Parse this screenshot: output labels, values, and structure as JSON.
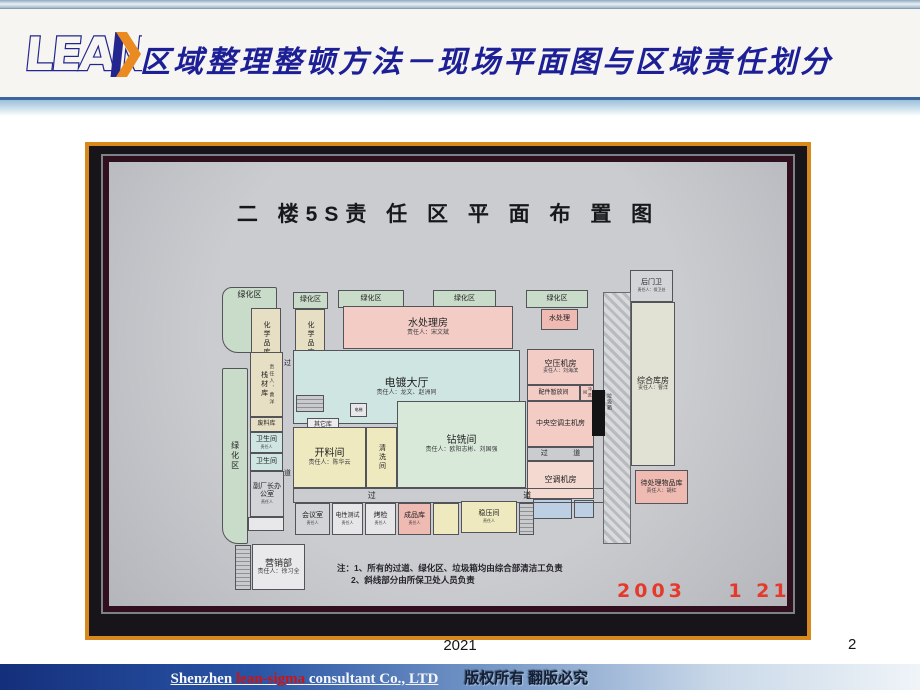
{
  "header": {
    "logo_text": "LEAN",
    "title": "区域整理整顿方法－现场平面图与区域责任划分"
  },
  "photo": {
    "board_title": "二 楼5S责 任 区 平 面 布 置 图",
    "date": "2003    1 21",
    "notes_line1": "注：1、所有的过道、绿化区、垃圾箱均由综合部清洁工负责",
    "notes_line2": "2、斜线部分由所保卫处人员负责",
    "trash_label": "垃圾箱",
    "rooms": [
      {
        "name": "green-area-1",
        "label": "绿化区",
        "x": 133,
        "y": 141,
        "w": 55,
        "h": 66,
        "bg": "#c9dbc9",
        "round": "10px 2px 2px 16px",
        "top": 1,
        "fs": 8
      },
      {
        "name": "green-area-2",
        "label": "绿化区",
        "x": 204,
        "y": 146,
        "w": 35,
        "h": 17,
        "bg": "#c9dbc9",
        "fs": 7
      },
      {
        "name": "green-area-3",
        "label": "绿化区",
        "x": 249,
        "y": 144,
        "w": 66,
        "h": 18,
        "bg": "#c9dbc9",
        "fs": 7
      },
      {
        "name": "green-area-4",
        "label": "绿化区",
        "x": 344,
        "y": 144,
        "w": 63,
        "h": 18,
        "bg": "#c9dbc9",
        "fs": 7
      },
      {
        "name": "green-area-5",
        "label": "绿化区",
        "x": 437,
        "y": 144,
        "w": 62,
        "h": 18,
        "bg": "#c9dbc9",
        "fs": 7
      },
      {
        "name": "chemical-store-1",
        "label": "化学品库",
        "x": 162,
        "y": 162,
        "w": 30,
        "h": 62,
        "bg": "#e7dfc3",
        "vert": 1,
        "fs": 7
      },
      {
        "name": "chemical-store-2",
        "label": "化学品库",
        "x": 206,
        "y": 163,
        "w": 30,
        "h": 60,
        "bg": "#e7dfc3",
        "vert": 1,
        "fs": 7
      },
      {
        "name": "water-treatment-room",
        "label": "水处理房",
        "sub": "责任人：宋文斌",
        "x": 254,
        "y": 160,
        "w": 170,
        "h": 43,
        "bg": "#f2ccc5",
        "fs": 10,
        "sfs": 6
      },
      {
        "name": "water-treatment-small",
        "label": "水处理",
        "x": 452,
        "y": 163,
        "w": 37,
        "h": 21,
        "bg": "#eebab2",
        "fs": 7
      },
      {
        "name": "plating-hall",
        "label": "电镀大厅",
        "sub": "责任人：龙文、赵洲同",
        "x": 204,
        "y": 204,
        "w": 227,
        "h": 74,
        "bg": "#cfe5e1",
        "fs": 11,
        "sfs": 6
      },
      {
        "name": "air-compressor-room",
        "label": "空压机房",
        "sub": "责任人：刘海滨",
        "x": 438,
        "y": 203,
        "w": 67,
        "h": 36,
        "bg": "#f2ccc5",
        "fs": 8,
        "sfs": 5
      },
      {
        "name": "parts-staging-room",
        "label": "配件暂放间",
        "x": 438,
        "y": 239,
        "w": 53,
        "h": 16,
        "bg": "#f2ccc5",
        "fs": 6
      },
      {
        "name": "rinse-room",
        "label": "冲洗间",
        "x": 491,
        "y": 239,
        "w": 14,
        "h": 16,
        "bg": "#f2ccc5",
        "fs": 4,
        "vert": 1
      },
      {
        "name": "central-ac-room",
        "label": "中央空调主机房",
        "x": 438,
        "y": 255,
        "w": 67,
        "h": 46,
        "bg": "#f2ccc5",
        "fs": 7
      },
      {
        "name": "corridor-right",
        "label": "过",
        "label2": "道",
        "x": 438,
        "y": 301,
        "w": 67,
        "h": 14,
        "fs": 7
      },
      {
        "name": "ac-room",
        "label": "空调机房",
        "x": 438,
        "y": 315,
        "w": 67,
        "h": 38,
        "bg": "#f3d9d0",
        "fs": 8
      },
      {
        "name": "small-room-blue-1",
        "label": "",
        "x": 444,
        "y": 353,
        "w": 39,
        "h": 20,
        "bg": "#bdd0e3"
      },
      {
        "name": "small-room-blue-2",
        "label": "",
        "x": 485,
        "y": 354,
        "w": 20,
        "h": 18,
        "bg": "#bdd0e3"
      },
      {
        "name": "back-gate-guard",
        "label": "后门卫",
        "sub": "责任人：保卫处",
        "x": 541,
        "y": 124,
        "w": 43,
        "h": 32,
        "bg": "#d3d4d7",
        "fs": 7,
        "sfs": 4
      },
      {
        "name": "general-warehouse",
        "label": "综合库房",
        "sub": "责任人：曹洋",
        "x": 542,
        "y": 156,
        "w": 44,
        "h": 164,
        "bg": "#e2e2d4",
        "fs": 8,
        "sfs": 5
      },
      {
        "name": "pending-items-store",
        "label": "待处理物品库",
        "sub": "责任人：胡红",
        "x": 546,
        "y": 324,
        "w": 53,
        "h": 34,
        "bg": "#eebab2",
        "fs": 7,
        "sfs": 5
      },
      {
        "name": "green-area-left",
        "label": "绿化区",
        "x": 133,
        "y": 222,
        "w": 26,
        "h": 176,
        "bg": "#c9dbc9",
        "vert": 1,
        "round": "2px 2px 2px 16px",
        "fs": 8
      },
      {
        "name": "rack-material-store",
        "label": "栈材库",
        "sub": "责任人、曹洋",
        "x": 161,
        "y": 206,
        "w": 33,
        "h": 65,
        "bg": "#e7dfc3",
        "fs": 7,
        "sfs": 5,
        "vert": 1
      },
      {
        "name": "waste-store",
        "label": "废料库",
        "x": 161,
        "y": 271,
        "w": 33,
        "h": 15,
        "bg": "#e7dfc3",
        "fs": 6
      },
      {
        "name": "restroom-1",
        "label": "卫生间",
        "sub": "责任人",
        "x": 161,
        "y": 286,
        "w": 33,
        "h": 21,
        "bg": "#cfe5e1",
        "fs": 7,
        "sfs": 4
      },
      {
        "name": "restroom-2",
        "label": "卫生间",
        "x": 161,
        "y": 307,
        "w": 33,
        "h": 18,
        "bg": "#cfe5e1",
        "fs": 7
      },
      {
        "name": "deputy-director-office",
        "label": "副厂长办公室",
        "sub": "责任人",
        "x": 161,
        "y": 325,
        "w": 34,
        "h": 46,
        "bg": "#d3d4d7",
        "fs": 7,
        "sfs": 4
      },
      {
        "name": "small-room-1",
        "label": "",
        "x": 159,
        "y": 371,
        "w": 36,
        "h": 14,
        "bg": "#e8e8ea"
      },
      {
        "name": "corridor-char-top",
        "label": "过",
        "x": 193,
        "y": 212,
        "w": 11,
        "h": 13,
        "fs": 7,
        "noborder": 1
      },
      {
        "name": "corridor-char-bottom",
        "label": "道",
        "x": 193,
        "y": 322,
        "w": 11,
        "h": 13,
        "fs": 7,
        "noborder": 1
      },
      {
        "name": "stairs-mid",
        "label": "",
        "x": 207,
        "y": 249,
        "w": 28,
        "h": 17,
        "stairs": 1
      },
      {
        "name": "elevator",
        "label": "电梯",
        "x": 261,
        "y": 257,
        "w": 17,
        "h": 14,
        "bg": "#e8e8ea",
        "fs": 4
      },
      {
        "name": "other-store",
        "label": "其它库",
        "x": 218,
        "y": 272,
        "w": 32,
        "h": 14,
        "bg": "#ececee",
        "fs": 6
      },
      {
        "name": "cutting-room",
        "label": "开料间",
        "sub": "责任人：陈华云",
        "x": 204,
        "y": 281,
        "w": 73,
        "h": 61,
        "bg": "#efe9c0",
        "fs": 10,
        "sfs": 6
      },
      {
        "name": "cleaning-room",
        "label": "清洗间",
        "x": 277,
        "y": 281,
        "w": 31,
        "h": 61,
        "bg": "#efe9c0",
        "fs": 7,
        "vert": 1
      },
      {
        "name": "drilling-milling-room",
        "label": "钻铣间",
        "sub": "责任人：欧阳志彬、刘国强",
        "x": 308,
        "y": 255,
        "w": 129,
        "h": 87,
        "bg": "#d8e9da",
        "fs": 10,
        "sfs": 6
      },
      {
        "name": "corridor-main",
        "label": "过",
        "label2": "道",
        "x": 204,
        "y": 342,
        "w": 313,
        "h": 15,
        "fs": 8
      },
      {
        "name": "meeting-room",
        "label": "会议室",
        "sub": "责任人",
        "x": 206,
        "y": 357,
        "w": 35,
        "h": 32,
        "bg": "#d3d4d7",
        "fs": 7,
        "sfs": 4
      },
      {
        "name": "electrical-test-room",
        "label": "电性测试",
        "sub": "责任人",
        "x": 243,
        "y": 357,
        "w": 31,
        "h": 32,
        "bg": "#e6e6e8",
        "fs": 6,
        "sfs": 4
      },
      {
        "name": "bake-inspection-room",
        "label": "烤检",
        "sub": "责任人",
        "x": 276,
        "y": 357,
        "w": 31,
        "h": 32,
        "bg": "#e6e6e8",
        "fs": 7,
        "sfs": 4
      },
      {
        "name": "finished-goods-store",
        "label": "成品库",
        "sub": "责任人",
        "x": 309,
        "y": 357,
        "w": 33,
        "h": 32,
        "bg": "#eebab2",
        "fs": 7,
        "sfs": 4
      },
      {
        "name": "room-blank-yellow",
        "label": "",
        "x": 344,
        "y": 357,
        "w": 26,
        "h": 32,
        "bg": "#efe9c0"
      },
      {
        "name": "voltage-regulator-room",
        "label": "稳压间",
        "sub": "责任人",
        "x": 372,
        "y": 355,
        "w": 56,
        "h": 32,
        "bg": "#efe9c0",
        "fs": 7,
        "sfs": 4
      },
      {
        "name": "stairs-right",
        "label": "",
        "x": 430,
        "y": 357,
        "w": 15,
        "h": 32,
        "stairs": 1
      },
      {
        "name": "marketing-dept",
        "label": "营销部",
        "sub": "责任人：徐习全",
        "x": 163,
        "y": 398,
        "w": 53,
        "h": 46,
        "bg": "#e9e9eb",
        "fs": 9,
        "sfs": 6
      },
      {
        "name": "stairs-bottom-left",
        "label": "",
        "x": 146,
        "y": 399,
        "w": 16,
        "h": 45,
        "stairs": 1
      }
    ]
  },
  "footer": {
    "year": "2021",
    "page": "2",
    "company_prefix": "Shenzhen ",
    "company_highlight": "lean-sigma",
    "company_suffix": " consultant Co., LTD",
    "copyright": "版权所有 翻版必究"
  }
}
